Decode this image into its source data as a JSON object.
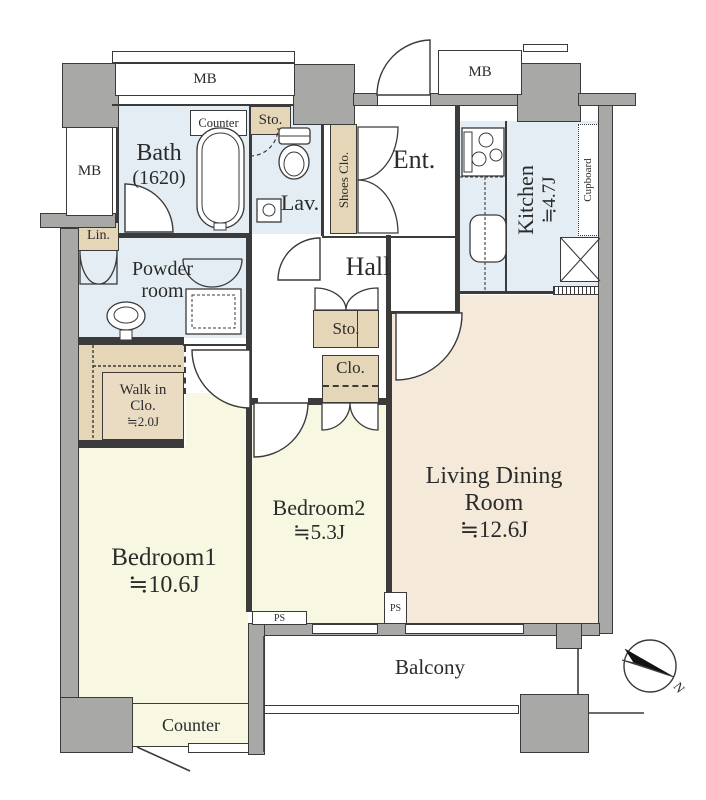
{
  "rooms": {
    "bath": {
      "name": "Bath",
      "size": "(1620)"
    },
    "lavatory": {
      "name": "Lav."
    },
    "powder_room": {
      "line1": "Powder",
      "line2": "room"
    },
    "entrance": {
      "name": "Ent."
    },
    "hall": {
      "name": "Hall"
    },
    "kitchen": {
      "name": "Kitchen",
      "size": "≒4.7J"
    },
    "living_dining": {
      "line1": "Living Dining",
      "line2": "Room",
      "size": "≒12.6J"
    },
    "bedroom1": {
      "name": "Bedroom1",
      "size": "≒10.6J"
    },
    "bedroom2": {
      "name": "Bedroom2",
      "size": "≒5.3J"
    },
    "walk_in_closet": {
      "line1": "Walk in",
      "line2": "Clo.",
      "size": "≒2.0J"
    },
    "balcony": {
      "name": "Balcony"
    }
  },
  "labels": {
    "mb": "MB",
    "ps": "PS",
    "sto": "Sto.",
    "clo": "Clo.",
    "lin": "Lin.",
    "shoes_closet": "Shoes Clo.",
    "cupboard": "Cupboard",
    "counter": "Counter",
    "north": "N"
  },
  "colors": {
    "wall": "#a8a8a6",
    "wet_room": "#e3edf3",
    "closet_tan": "#e6d6b8",
    "bedroom_cream": "#f8f7e1",
    "living_peach": "#f5e9da",
    "line": "#3a3a3a"
  }
}
